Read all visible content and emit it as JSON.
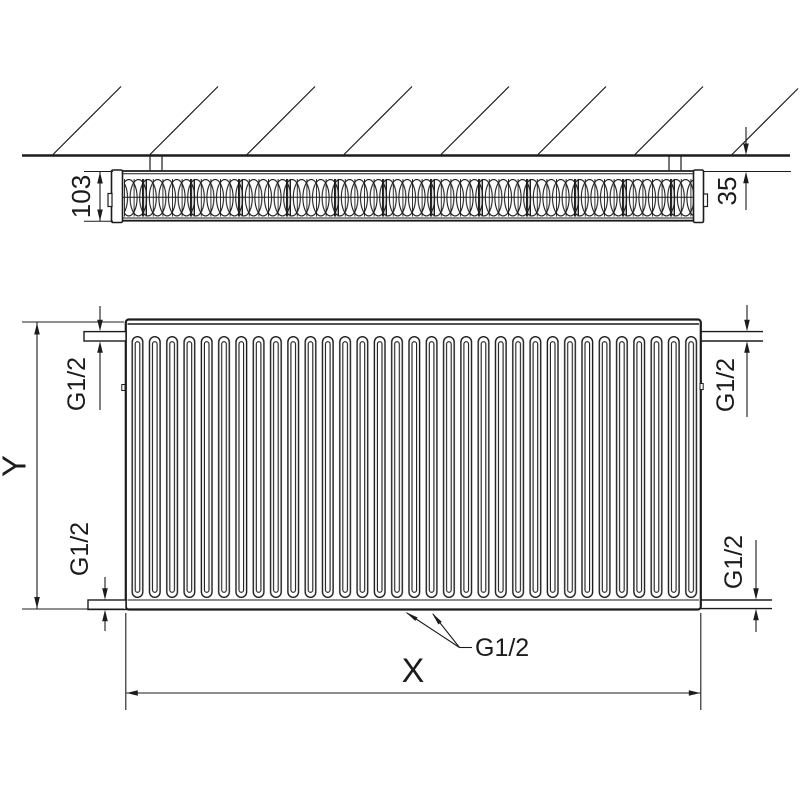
{
  "colors": {
    "line": "#1c1c1c",
    "background": "#ffffff"
  },
  "top_view": {
    "depth_dim": "103",
    "wall_clearance_dim": "35"
  },
  "front_view": {
    "height_dim": "Y",
    "length_dim": "X",
    "conn_top_left": "G1/2",
    "conn_top_right": "G1/2",
    "conn_bottom_left": "G1/2",
    "conn_bottom_right": "G1/2",
    "conn_bottom_center": "G1/2"
  }
}
